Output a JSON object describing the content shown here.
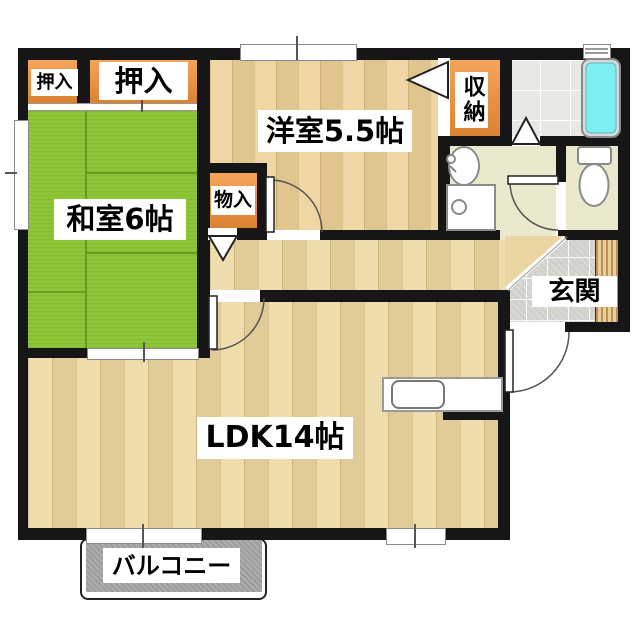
{
  "plan": {
    "type": "apartment-floor-plan",
    "rooms": {
      "oshiire_small": {
        "label": "押入"
      },
      "oshiire_large": {
        "label": "押入"
      },
      "washitsu": {
        "label": "和室6帖"
      },
      "youshitsu": {
        "label": "洋室5.5帖"
      },
      "monoire": {
        "label": "物入"
      },
      "shuunou": {
        "label": "収納"
      },
      "genkan": {
        "label": "玄関"
      },
      "ldk": {
        "label": "LDK14帖"
      },
      "balcony": {
        "label": "バルコニー"
      }
    },
    "fixtures": [
      "bathtub",
      "toilet",
      "washbasin",
      "washing-machine-pan",
      "kitchen-counter",
      "kitchen-sink",
      "shoe-cabinet",
      "sliding-doors",
      "hinged-doors",
      "bifold-doors",
      "windows"
    ],
    "colors": {
      "wall_black": "#161616",
      "tatami_green": "#8cc636",
      "closet_orange": "#e89544",
      "wood_floor": "#ecd7a0",
      "bathtub_cyan": "#7deef2",
      "entry_tile_gray": "#d8d8d3",
      "washroom_beige": "#eae9cd",
      "balcony_gray": "#a5a5a5"
    }
  }
}
